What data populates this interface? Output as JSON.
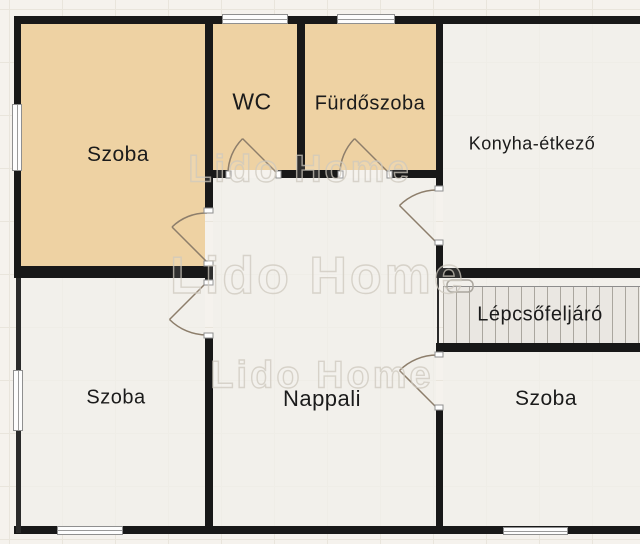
{
  "floorplan": {
    "watermark": {
      "text": "Lido Home"
    },
    "rooms": [
      {
        "id": "szoba-top-left",
        "label": "Szoba"
      },
      {
        "id": "wc",
        "label": "WC"
      },
      {
        "id": "furdoszoba",
        "label": "Fürdőszoba"
      },
      {
        "id": "konyha-etkezo",
        "label": "Konyha-étkező"
      },
      {
        "id": "szoba-bottom-left",
        "label": "Szoba"
      },
      {
        "id": "nappali",
        "label": "Nappali"
      },
      {
        "id": "lepcsofeljaro",
        "label": "Lépcsőfeljáró"
      },
      {
        "id": "szoba-bottom-right",
        "label": "Szoba"
      }
    ],
    "colors": {
      "highlighted_room": "#eed2a3",
      "room": "#f1efea",
      "wall": "#181818",
      "background": "#f5f2ed",
      "stairs": "#eae7e2",
      "door_arc": "#8d7e6b"
    }
  }
}
